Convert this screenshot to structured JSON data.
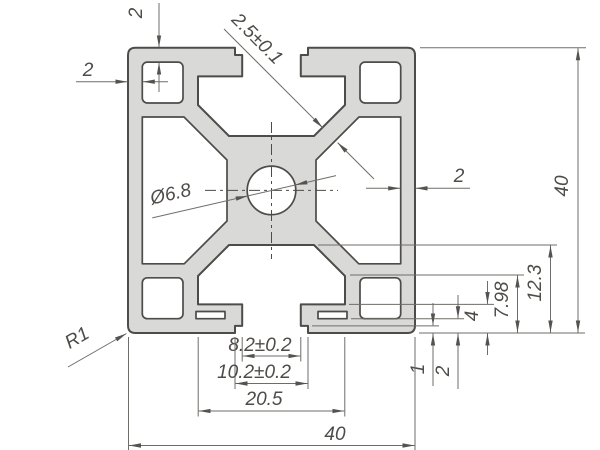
{
  "drawing": {
    "type": "aluminium-extrusion-profile-cross-section",
    "dimensions": {
      "wall_top": "2",
      "wall_left": "2",
      "wall_right": "2",
      "diagonal_web": "2.5±0.1",
      "center_hole": "Ø6.8",
      "corner_radius": "R1",
      "height_total": "40",
      "width_total": "40",
      "cavity_width": "20.5",
      "slot_step": "10.2±0.2",
      "slot_opening": "8.2±0.2",
      "cavity_depth": "12.3",
      "lip_ledge": "7.98",
      "lip_top": "4",
      "slit_bottom": "2",
      "step_depth": "1"
    },
    "colors": {
      "profile_fill": "#d9d9d8",
      "outline": "#4e4c48",
      "dimension_lines": "#6f6d69",
      "background": "#ffffff"
    }
  }
}
